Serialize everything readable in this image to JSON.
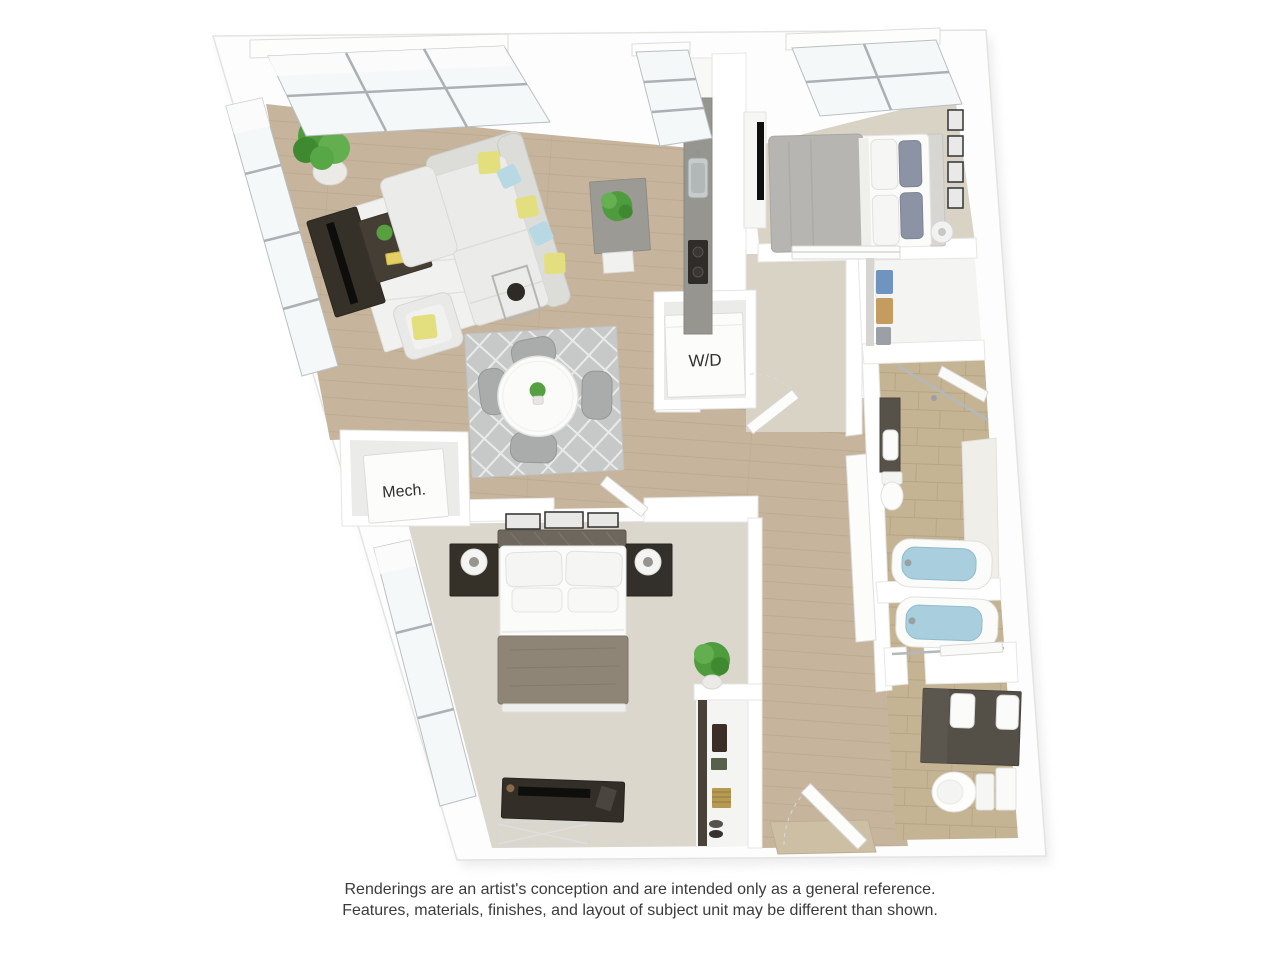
{
  "floorplan": {
    "labels": {
      "washer_dryer": "W/D",
      "mechanical": "Mech."
    },
    "disclaimer": {
      "line1": "Renderings are an artist's conception and are intended only as a general reference.",
      "line2": "Features, materials, finishes, and layout of subject unit may be different than shown."
    },
    "palette": {
      "background": "#ffffff",
      "wall": "#ffffff",
      "wall_edge": "#e6e6e4",
      "wood_floor": "#c6b59c",
      "wood_plank_line": "#b2a188",
      "carpet_bedroom_top": "#d9d3c6",
      "carpet_bedroom_bottom": "#dcd7cc",
      "closet_floor": "#f4f4f2",
      "bath_tile": "#c4b494",
      "tile_grout": "#b1a181",
      "tub_water": "#a9cedd",
      "sofa_fabric": "#ebebe9",
      "pillow_yellow": "#e3df7f",
      "pillow_blue": "#b8d9e4",
      "dark_wood_furniture": "#353028",
      "taupe_blanket": "#8e8577",
      "plant_green": "#4f9c3e",
      "rug_living": "#f1f1ef",
      "rug_dining": "#c6c9c8",
      "label_text": "#2f2f2f",
      "disclaimer_text": "#3b3b3b"
    }
  }
}
